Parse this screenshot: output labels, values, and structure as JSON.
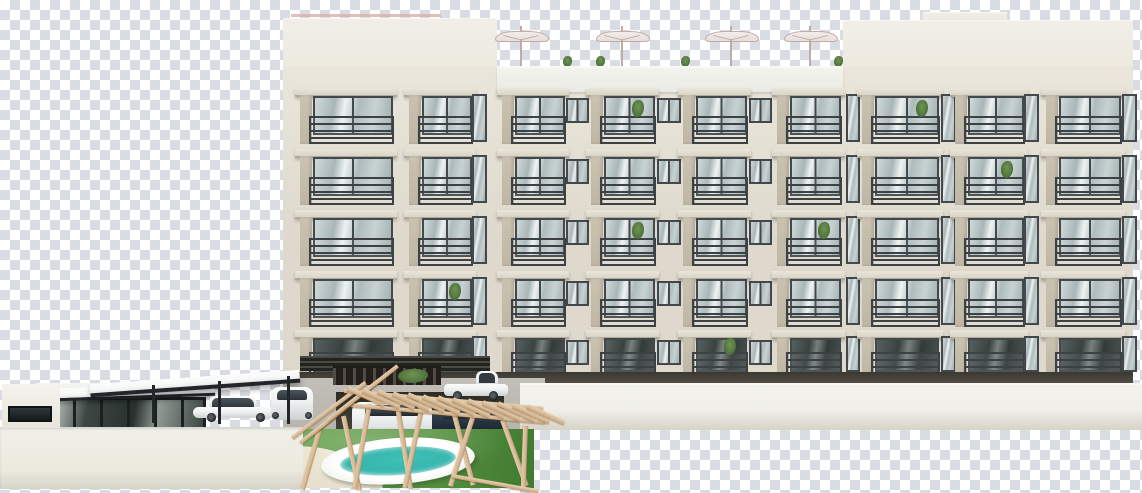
{
  "scene": {
    "type": "architectural-render",
    "subject": "Five-story apartment building elevation with rooftop terrace umbrellas, balconies, ground-floor parking, flat-roof clubhouse with carport and cars, wooden pergola over a pool garden, shown on a transparency checkerboard",
    "canvas": {
      "w": 1142,
      "h": 493
    },
    "palette": {
      "checkerLight": "#ffffff",
      "checkerDark": "#d9dce2",
      "facade": "#ded9cc",
      "facadeLight": "#eae6db",
      "parapetDeck": "#e9ebe4",
      "pier": "#cbc3b1",
      "slab": "#d9d4c6",
      "frame": "#43484d",
      "railing": "#3c4145",
      "pinkRail": "#d9b0a8",
      "umbrella": "#e7dfdc",
      "umbrellaLine": "#bfaca7",
      "plant": "#55793f",
      "darkBand": "#57534b",
      "concrete": "#b7b4ac",
      "garage": "#46423a",
      "wallFront": "#f0efe9",
      "wallShade": "#d6d3c8",
      "roofWhite": "#f7f8f7",
      "fascia": "#22262a",
      "glassClub": "#3c4743",
      "carWhite": "#eef1f1",
      "carDark": "#23303d",
      "wheel": "#26292c",
      "grass": "#63a14b",
      "grassDark": "#3f7a30",
      "hedge": "#4a6f38",
      "poolDeck": "#eff3ec",
      "poolWater": "#3fc1b8",
      "poolWaterLight": "#a5e2d9",
      "wood": "#d9bd9d",
      "path": "#e6decb"
    },
    "roof": {
      "left_parapet": {
        "x": 283,
        "y": 18,
        "w": 214,
        "h": 76
      },
      "right_parapet": {
        "x": 843,
        "y": 20,
        "w": 290,
        "h": 74
      },
      "right_step": {
        "x": 923,
        "y": 12,
        "w": 84,
        "h": 12
      },
      "deck_parapet": {
        "x": 497,
        "y": 66,
        "w": 346,
        "h": 26
      },
      "accent_rail": {
        "x": 291,
        "y": 14,
        "w": 150,
        "h": 3
      },
      "umbrella_x": [
        521,
        622,
        731,
        810
      ],
      "umbrella_y": 29,
      "plant_x": [
        563,
        596,
        681,
        834
      ]
    },
    "facade": {
      "x": 283,
      "y": 66,
      "w": 850,
      "h": 320
    },
    "rows": [
      88,
      149,
      210,
      271,
      330
    ],
    "row_h": 56,
    "ground_row_h": 44,
    "bays": [
      {
        "x": 300,
        "w": 90,
        "t": "B"
      },
      {
        "x": 409,
        "w": 60,
        "t": "b"
      },
      {
        "x": 472,
        "w": 11,
        "t": "s"
      },
      {
        "x": 502,
        "w": 60,
        "t": "b"
      },
      {
        "x": 566,
        "w": 19,
        "t": "w"
      },
      {
        "x": 591,
        "w": 61,
        "t": "b"
      },
      {
        "x": 657,
        "w": 20,
        "t": "w"
      },
      {
        "x": 683,
        "w": 61,
        "t": "b"
      },
      {
        "x": 749,
        "w": 19,
        "t": "w"
      },
      {
        "x": 777,
        "w": 61,
        "t": "b"
      },
      {
        "x": 846,
        "w": 10,
        "t": "s"
      },
      {
        "x": 862,
        "w": 74,
        "t": "b"
      },
      {
        "x": 941,
        "w": 11,
        "t": "s"
      },
      {
        "x": 955,
        "w": 66,
        "t": "b"
      },
      {
        "x": 1024,
        "w": 11,
        "t": "s"
      },
      {
        "x": 1046,
        "w": 72,
        "t": "b"
      },
      {
        "x": 1122,
        "w": 11,
        "t": "s"
      }
    ],
    "balcony_plants": [
      {
        "row": 0,
        "bay": 5
      },
      {
        "row": 0,
        "bay": 11
      },
      {
        "row": 1,
        "bay": 13
      },
      {
        "row": 2,
        "bay": 5
      },
      {
        "row": 2,
        "bay": 9
      },
      {
        "row": 3,
        "bay": 1
      },
      {
        "row": 4,
        "bay": 7
      }
    ],
    "ground": {
      "band": {
        "x": 283,
        "y": 372,
        "w": 850,
        "h": 14
      },
      "louver": {
        "x": 300,
        "y": 356,
        "w": 190,
        "h": 15
      },
      "concrete": {
        "x": 283,
        "y": 378,
        "w": 262,
        "h": 52
      },
      "garage": {
        "x": 336,
        "y": 392,
        "w": 168,
        "h": 40
      },
      "fence": {
        "x": 333,
        "y": 366,
        "w": 108,
        "h": 17
      },
      "hedge": {
        "x": 398,
        "y": 369,
        "w": 30,
        "h": 14
      }
    },
    "walls": {
      "right": {
        "x": 520,
        "y": 383,
        "w": 622,
        "h": 47
      },
      "left": {
        "x": 0,
        "y": 427,
        "w": 305,
        "h": 62
      },
      "mini_parapet": {
        "x": 2,
        "y": 384,
        "w": 58,
        "h": 44
      },
      "mini_window": {
        "x": 8,
        "y": 406,
        "w": 40,
        "h": 12
      }
    },
    "clubhouse": {
      "body": {
        "x": 36,
        "y": 383,
        "w": 168,
        "h": 44
      },
      "glass": {
        "x": 46,
        "y": 397,
        "w": 154,
        "h": 28
      },
      "roof": {
        "x": 30,
        "y": 386,
        "w": 185,
        "h": 10,
        "rot": -2
      },
      "canopy": {
        "x": 90,
        "y": 377,
        "w": 210,
        "h": 9,
        "rot": -4
      },
      "posts": [
        {
          "x": 152,
          "y": 385,
          "h": 38
        },
        {
          "x": 218,
          "y": 381,
          "h": 43
        },
        {
          "x": 287,
          "y": 376,
          "h": 48
        }
      ]
    },
    "cars": [
      {
        "kind": "sedan-side",
        "x": 193,
        "y": 396,
        "w": 88,
        "h": 25,
        "dark": false
      },
      {
        "kind": "hatch-rear",
        "x": 271,
        "y": 387,
        "w": 42,
        "h": 33,
        "dark": false
      },
      {
        "kind": "pickup-side",
        "x": 444,
        "y": 371,
        "w": 64,
        "h": 29,
        "dark": false
      },
      {
        "kind": "car-front",
        "x": 352,
        "y": 402,
        "w": 80,
        "h": 36,
        "dark": false
      },
      {
        "kind": "car-front",
        "x": 432,
        "y": 406,
        "w": 70,
        "h": 33,
        "dark": true
      }
    ],
    "garden": {
      "rect": {
        "x": 303,
        "y": 429,
        "w": 231,
        "h": 59
      },
      "pool_deck": {
        "cx": 95,
        "cy": 32,
        "rx": 77,
        "ry": 23,
        "rot": -4
      },
      "pool_water": {
        "rx": 58,
        "ry": 14
      },
      "path": {
        "x": -28,
        "y": 22,
        "w": 110,
        "h": 48,
        "rot": 18
      }
    },
    "pergola": {
      "legs": [
        {
          "x": 317,
          "y": 430,
          "h": 62,
          "r": 16
        },
        {
          "x": 341,
          "y": 416,
          "h": 76,
          "r": -12
        },
        {
          "x": 367,
          "y": 404,
          "h": 86,
          "r": 10
        },
        {
          "x": 394,
          "y": 400,
          "h": 90,
          "r": -9
        },
        {
          "x": 421,
          "y": 400,
          "h": 90,
          "r": 12
        },
        {
          "x": 449,
          "y": 404,
          "h": 84,
          "r": -15
        },
        {
          "x": 472,
          "y": 412,
          "h": 78,
          "r": 18
        },
        {
          "x": 500,
          "y": 420,
          "h": 70,
          "r": -20
        },
        {
          "x": 523,
          "y": 426,
          "h": 64,
          "r": 2
        }
      ],
      "beams": [
        {
          "x": 344,
          "y": 389,
          "w": 200,
          "h": 4,
          "r": 5
        },
        {
          "x": 350,
          "y": 403,
          "w": 196,
          "h": 4,
          "r": 5
        },
        {
          "x": 292,
          "y": 436,
          "w": 92,
          "h": 4,
          "r": -37
        }
      ],
      "slat_runs": [
        {
          "x": 300,
          "y": 441,
          "dx": 9,
          "dy": -7.2,
          "n": 8,
          "w": 44,
          "h": 4,
          "r": -38
        },
        {
          "x": 348,
          "y": 386,
          "dx": 15,
          "dy": 1.5,
          "n": 13,
          "w": 40,
          "h": 5,
          "r": 24
        }
      ],
      "rail": {
        "x": 452,
        "y": 474,
        "w": 88,
        "h": 4,
        "r": 10
      }
    }
  }
}
